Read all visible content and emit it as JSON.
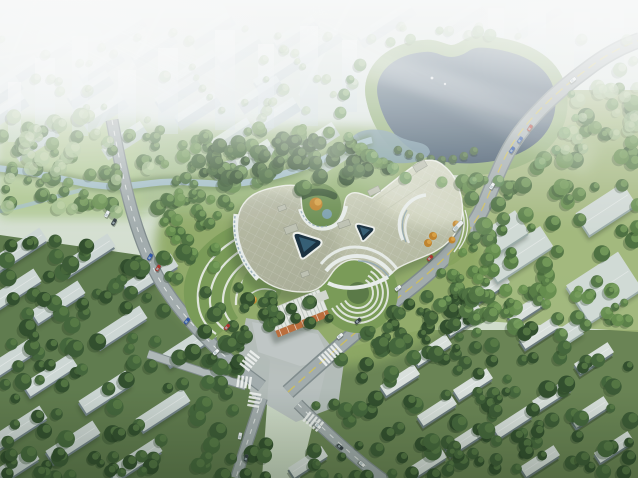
{
  "alt_text": "Aerial architectural rendering: tri-lobed cream hospital campus with triangular glass courtyards, circular roof garden, terraced green amphitheaters, surrounded by tree-lined roads, a kidney-shaped lake upper right, hazy high-rise city at top, and diagonal rows of residential slab blocks lower left and right",
  "palette": {
    "sky_top": "#f2f7f5",
    "ground_top": "#e6eee6",
    "ground_bot": "#cfdcc6",
    "city_body": "#c7d4dc",
    "city_top": "#eef4f7",
    "tower": "#cfdde6",
    "lake_deep": "#3c5064",
    "lake_mid": "#50687c",
    "lake_ring": "#e6edee",
    "lake_grass": "#8fae6f",
    "wetland": "#7c9baa",
    "river": "#a6c2cb",
    "bank": "#5d7c49",
    "road": "#a7b0b1",
    "road_casing": "#848f90",
    "road_light": "#b4bcbc",
    "plaza": "#bcc3c2",
    "forecourt": "#c6cccb",
    "lane_yellow": "#d9c553",
    "marking": "#f5f7f5",
    "roof_light": "#dcdec9",
    "roof_dark": "#b7bba3",
    "roof_rim": "#fbfcf8",
    "roof_box": "#c3c6b6",
    "facade": "#eef2ef",
    "glass": "#8fa8b6",
    "court_glass": "#1b3242",
    "court_glass_lit": "#3f6b85",
    "terracotta": "#c0703d",
    "grass": "#93ad68",
    "lawn_light": "#b3cc92",
    "fan_green": "#7d9e59",
    "hill": "#86a75f",
    "east_lawn": "#a2b878",
    "autumn": "#c5872f",
    "autumn_light": "#e0a84a",
    "slab_top_sw": "#d3dcd9",
    "slab_side_sw": "#75848a",
    "slab_top_se": "#dfe6e2",
    "slab_side_se": "#6e7d80",
    "inst_top": "#d6dfda",
    "inst_side": "#9fb0ac",
    "car_white": "#f4f7f6",
    "car_red": "#b5372b",
    "car_blue": "#3059b0",
    "car_dark": "#343d42",
    "tree_shadow": "#243a22",
    "ground_sw": "#637e50",
    "ground_se": "#6d8756"
  },
  "tree_palettes": {
    "dark": [
      "#33502e",
      "#3d5c36",
      "#46683c"
    ],
    "mid": [
      "#4c7040",
      "#5a8048",
      "#68904f",
      "#527544"
    ],
    "pale": [
      "#8fb07c",
      "#9dba86",
      "#a9c492"
    ],
    "lakeside": [
      "#6f9a60",
      "#7fa76b",
      "#5d8a52"
    ]
  },
  "tree_highlights": {
    "dark": "#5d8049",
    "mid": "#7ba35c",
    "pale": "#c2d6a8",
    "lakeside": "#93b877"
  },
  "tree_belts": [
    [
      0,
      26,
      638,
      100,
      60,
      11,
      "pale",
      3,
      6,
      0.55
    ],
    [
      0,
      128,
      400,
      42,
      55,
      12,
      "mid",
      4,
      8,
      0.95
    ],
    [
      0,
      168,
      310,
      40,
      46,
      13,
      "mid",
      4,
      8,
      0.95
    ],
    [
      0,
      116,
      150,
      96,
      26,
      14,
      "pale",
      4,
      9,
      0.8
    ],
    [
      198,
      138,
      276,
      48,
      56,
      15,
      "dark",
      4,
      8,
      1
    ],
    [
      158,
      198,
      62,
      84,
      22,
      16,
      "mid",
      4,
      7,
      1
    ],
    [
      232,
      296,
      244,
      56,
      54,
      17,
      "dark",
      4,
      8,
      1
    ],
    [
      432,
      148,
      84,
      164,
      40,
      18,
      "mid",
      4,
      8,
      1
    ],
    [
      470,
      88,
      168,
      248,
      85,
      19,
      "mid",
      4,
      9,
      0.95
    ],
    [
      0,
      240,
      272,
      238,
      125,
      20,
      "dark",
      5,
      9,
      1
    ],
    [
      300,
      328,
      338,
      150,
      105,
      21,
      "dark",
      4,
      9,
      1
    ],
    [
      0,
      452,
      638,
      26,
      36,
      23,
      "dark",
      4,
      8,
      1
    ],
    [
      556,
      56,
      82,
      96,
      18,
      24,
      "pale",
      4,
      8,
      0.7
    ],
    [
      348,
      92,
      54,
      72,
      16,
      26,
      "mid",
      4,
      7,
      0.9
    ],
    [
      292,
      334,
      36,
      32,
      8,
      27,
      "dark",
      5,
      8,
      1
    ]
  ],
  "lake_ring_trees": {
    "cx": 458,
    "cy": 107,
    "rx": 112,
    "ry": 74,
    "n": 24,
    "seed": 31
  },
  "lake_shore_trees": [
    [
      398,
      150
    ],
    [
      409,
      154
    ],
    [
      420,
      157
    ],
    [
      431,
      159
    ],
    [
      442,
      160
    ],
    [
      453,
      159
    ],
    [
      464,
      156
    ],
    [
      474,
      151
    ]
  ],
  "distant_city": {
    "rows": [
      [
        20,
        390,
        3,
        78
      ],
      [
        34,
        120,
        4,
        86
      ],
      [
        52,
        60,
        6,
        88
      ],
      [
        72,
        20,
        7,
        86
      ],
      [
        94,
        0,
        7,
        88
      ],
      [
        116,
        10,
        7,
        90
      ],
      [
        140,
        40,
        5,
        92
      ],
      [
        158,
        245,
        2,
        96
      ]
    ],
    "slab_w": 48,
    "slab_h": 13,
    "rot": -33,
    "towers": [
      [
        35,
        58,
        20,
        88
      ],
      [
        72,
        36,
        16,
        100
      ],
      [
        118,
        70,
        18,
        70
      ],
      [
        158,
        48,
        20,
        86
      ],
      [
        215,
        30,
        20,
        100
      ],
      [
        258,
        44,
        16,
        84
      ],
      [
        300,
        26,
        18,
        100
      ],
      [
        342,
        40,
        15,
        72
      ],
      [
        8,
        82,
        13,
        60
      ],
      [
        488,
        8,
        16,
        62
      ],
      [
        528,
        2,
        18,
        72
      ],
      [
        574,
        12,
        16,
        58
      ],
      [
        610,
        6,
        14,
        62
      ]
    ]
  },
  "residential_sw": {
    "rot": -33,
    "w": 56,
    "h": 15,
    "slabs": [
      [
        20,
        249
      ],
      [
        88,
        255
      ],
      [
        151,
        275
      ],
      [
        14,
        290
      ],
      [
        58,
        302
      ],
      [
        120,
        327
      ],
      [
        190,
        345
      ],
      [
        10,
        360
      ],
      [
        50,
        375
      ],
      [
        106,
        392
      ],
      [
        163,
        410
      ],
      [
        20,
        427
      ],
      [
        73,
        442
      ],
      [
        135,
        460
      ],
      [
        12,
        468
      ]
    ]
  },
  "residential_se": {
    "rot": -33,
    "w": 40,
    "h": 12,
    "slabs": [
      [
        490,
        288
      ],
      [
        527,
        309
      ],
      [
        464,
        320
      ],
      [
        432,
        350
      ],
      [
        400,
        380
      ],
      [
        539,
        333
      ],
      [
        594,
        358
      ],
      [
        552,
        395
      ],
      [
        473,
        384
      ],
      [
        437,
        410
      ],
      [
        513,
        422
      ],
      [
        590,
        412
      ],
      [
        464,
        440
      ],
      [
        540,
        461
      ],
      [
        614,
        447
      ],
      [
        427,
        463
      ],
      [
        308,
        462
      ]
    ]
  },
  "institutional": {
    "rot": -33,
    "boxes": [
      [
        519,
        254,
        66,
        24
      ],
      [
        606,
        209,
        56,
        26
      ],
      [
        507,
        231,
        36,
        26
      ],
      [
        604,
        287,
        62,
        44
      ],
      [
        572,
        330,
        20,
        16
      ]
    ]
  },
  "vehicles": [
    [
      107,
      214,
      -62,
      "white"
    ],
    [
      114,
      222,
      -62,
      "dark"
    ],
    [
      150,
      257,
      -60,
      "blue"
    ],
    [
      158,
      268,
      -60,
      "red"
    ],
    [
      187,
      321,
      -50,
      "blue"
    ],
    [
      227,
      327,
      -48,
      "red"
    ],
    [
      216,
      352,
      -44,
      "white"
    ],
    [
      340,
      336,
      -40,
      "white"
    ],
    [
      358,
      321,
      -40,
      "dark"
    ],
    [
      398,
      288,
      -38,
      "white"
    ],
    [
      430,
      258,
      -44,
      "red"
    ],
    [
      458,
      226,
      -46,
      "bus"
    ],
    [
      492,
      186,
      -58,
      "white"
    ],
    [
      512,
      150,
      -56,
      "blue"
    ],
    [
      520,
      140,
      -56,
      "blue"
    ],
    [
      530,
      128,
      -58,
      "red"
    ],
    [
      318,
      426,
      40,
      "white"
    ],
    [
      340,
      447,
      40,
      "dark"
    ],
    [
      362,
      464,
      40,
      "white"
    ],
    [
      240,
      436,
      -78,
      "white"
    ],
    [
      246,
      458,
      -78,
      "dark"
    ],
    [
      573,
      80,
      -38,
      "white"
    ]
  ],
  "crosswalks": [
    [
      244,
      368,
      -52,
      5
    ],
    [
      322,
      362,
      -42,
      6
    ],
    [
      306,
      416,
      38,
      5
    ],
    [
      253,
      407,
      -80,
      4
    ],
    [
      237,
      381,
      8,
      4
    ]
  ],
  "autumn_trees": [
    [
      316,
      204,
      6.5
    ],
    [
      433,
      236,
      4
    ],
    [
      428,
      243,
      4
    ],
    [
      452,
      240,
      3.5
    ],
    [
      456,
      224,
      3.5
    ],
    [
      253,
      300,
      4
    ]
  ]
}
